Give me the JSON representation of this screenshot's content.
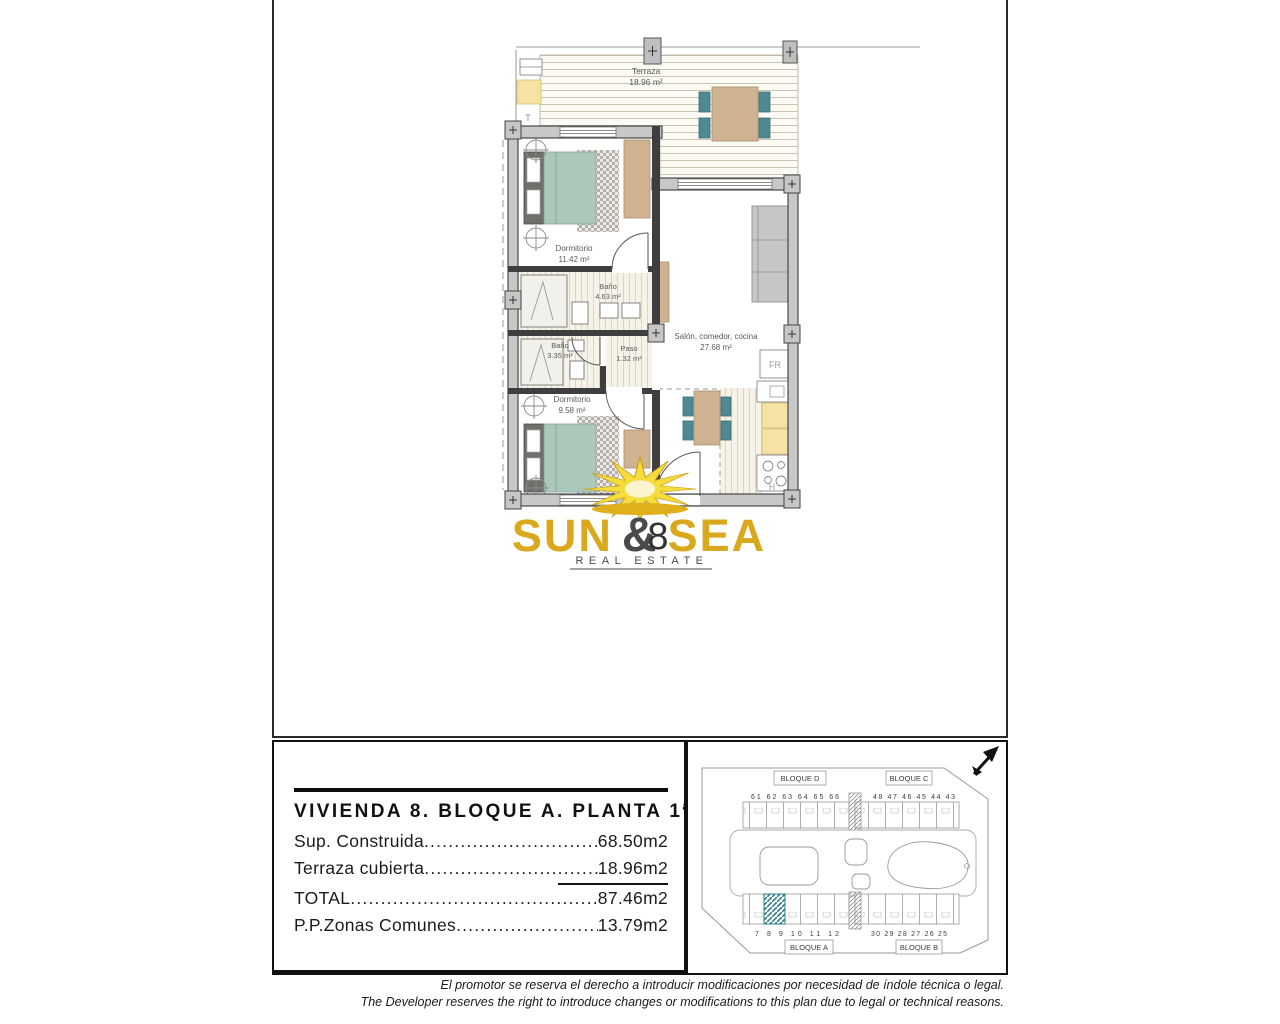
{
  "floor_plan": {
    "unit_number": "8",
    "terrace": {
      "name": "Terraza",
      "area": "18.96 m²",
      "corner_label": "T"
    },
    "bedroom1": {
      "name": "Dormitorio",
      "area": "11.42 m²"
    },
    "bath1": {
      "name": "Baño",
      "area": "4.63 m²"
    },
    "bath2": {
      "name": "Baño",
      "area": "3.35 m²"
    },
    "hall": {
      "name": "Paso",
      "area": "1.32 m²"
    },
    "living": {
      "name": "Salón, comedor, cocina",
      "area": "27.68 m²"
    },
    "bedroom2": {
      "name": "Dormitorio",
      "area": "9.58 m²"
    },
    "appliances": {
      "fridge": "FR",
      "oven": "H"
    }
  },
  "logo": {
    "word_sun": "SUN",
    "ampersand": "&",
    "word_sea": "SEA",
    "tagline": "REAL ESTATE",
    "gold": "#D9A81C",
    "dark_gray": "#4A4A4A"
  },
  "info_panel": {
    "title": "VIVIENDA 8. BLOQUE A. PLANTA 1ª",
    "rows": [
      {
        "label": "Sup. Construida",
        "value": "68.50m2"
      },
      {
        "label": "Terraza cubierta",
        "value": "18.96m2"
      },
      {
        "label": "TOTAL",
        "value": "87.46m2"
      },
      {
        "label": "P.P.Zonas Comunes",
        "value": "13.79m2"
      }
    ]
  },
  "site_plan": {
    "block_d": "BLOQUE D",
    "block_c": "BLOQUE C",
    "block_a": "BLOQUE A",
    "block_b": "BLOQUE B",
    "numbers_top_left": "61 62 63 64 65 66",
    "numbers_top_right": "48 47 46 45 44 43",
    "numbers_bottom_left": "7 8 9 10 11 12",
    "numbers_bottom_right": "30 29 28 27 26 25",
    "highlight_color": "#2E7D8C"
  },
  "disclaimer": {
    "es": "El promotor se reserva el derecho a introducir modificaciones por necesidad de índole técnica o legal.",
    "en": "The Developer reserves the right to introduce changes or modifications to this plan due to legal or technical reasons."
  }
}
